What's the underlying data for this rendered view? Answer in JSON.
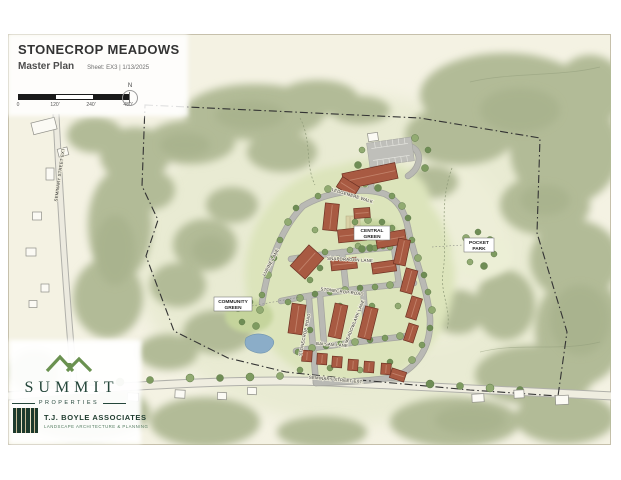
{
  "title_block": {
    "title": "STONECROP MEADOWS",
    "subtitle": "Master Plan",
    "sheet_info": "Sheet: EX3 | 1/13/2025",
    "scale_ticks": [
      "0",
      "120'",
      "240'",
      "480'"
    ],
    "north_label": "N"
  },
  "map": {
    "labels": {
      "central_green": {
        "line1": "CENTRAL",
        "line2": "GREEN"
      },
      "pocket_park": {
        "line1": "POCKET",
        "line2": "PARK"
      },
      "community_green": {
        "line1": "COMMUNITY",
        "line2": "GREEN"
      },
      "streets": {
        "ledgemere": "LEDGEMERE WALK",
        "snapdragon": "SNAPDRAGON LANE",
        "stonecrop_mid": "STONECROP ROAD",
        "stonecrop_south": "STONECROP ROAD",
        "lupine": "LUPINE LANE",
        "meadowlark": "MEADOWLARK LANE",
        "balsam": "BALSAM LANE",
        "seminary": "SEMINARY STREET EXT.",
        "seminary_west": "SEMINARY STREET EXT"
      }
    },
    "colors": {
      "building": "#a85a42",
      "building_stroke": "#6f3224",
      "building_ridge": "#c2826a",
      "white_building": "#fbfaf4",
      "forest": "#b2bb97",
      "field": "#e9ebd3",
      "road": "#b7b7b2",
      "pond": "#8badc8",
      "boundary": "#333333",
      "tree_greens": [
        "#7e9b60",
        "#92ab72",
        "#6f8d55"
      ]
    }
  },
  "branding": {
    "summit": {
      "name": "SUMMIT",
      "tagline": "PROPERTIES"
    },
    "tjboyle": {
      "name": "T.J. BOYLE ASSOCIATES",
      "tagline": "LANDSCAPE ARCHITECTURE & PLANNING"
    }
  }
}
